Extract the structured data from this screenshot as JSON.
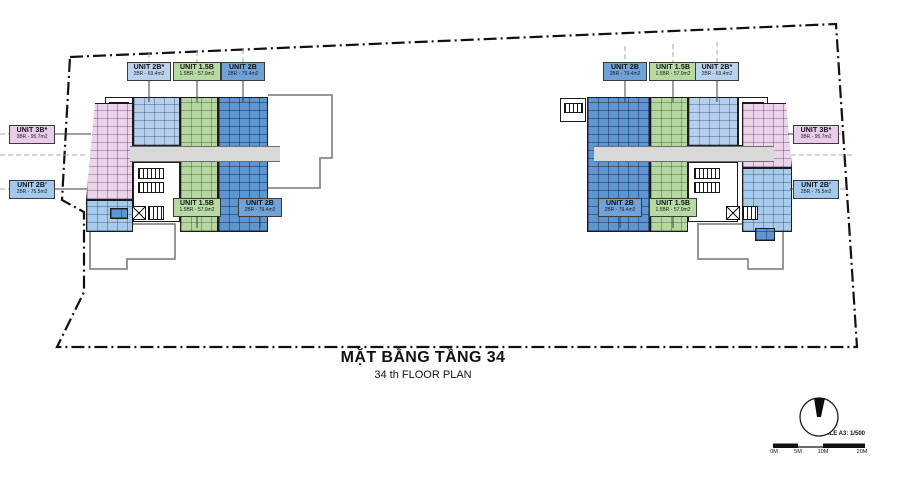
{
  "title": {
    "main": "MẶT BẰNG TẦNG 34",
    "sub": "34 th FLOOR PLAN"
  },
  "labels": [
    {
      "name": "UNIT 2B*",
      "area": "2BR - 69.4m2",
      "type": "2b_star"
    },
    {
      "name": "UNIT 1.5B",
      "area": "1.5BR - 57.0m2",
      "type": "1_5b"
    },
    {
      "name": "UNIT 2B",
      "area": "2BR - 79.4m2",
      "type": "2b"
    },
    {
      "name": "UNIT 1.5B",
      "area": "1.5BR - 57.0m2",
      "type": "1_5b"
    },
    {
      "name": "UNIT 2B",
      "area": "2BR - 79.4m2",
      "type": "2b"
    },
    {
      "name": "UNIT 3B*",
      "area": "3BR - 95.7m2",
      "type": "3b_star"
    },
    {
      "name": "UNIT 2B'",
      "area": "2BR - 75.5m2",
      "type": "2b_prime"
    },
    {
      "name": "UNIT 2B",
      "area": "2BR - 79.4m2",
      "type": "2b"
    },
    {
      "name": "UNIT 1.5B",
      "area": "1.5BR - 57.0m2",
      "type": "1_5b"
    },
    {
      "name": "UNIT 2B*",
      "area": "2BR - 69.4m2",
      "type": "2b_star"
    },
    {
      "name": "UNIT 2B",
      "area": "2BR - 79.4m2",
      "type": "2b"
    },
    {
      "name": "UNIT 1.5B",
      "area": "1.5BR - 57.0m2",
      "type": "1_5b"
    },
    {
      "name": "UNIT 3B*",
      "area": "3BR - 95.7m2",
      "type": "3b_star"
    },
    {
      "name": "UNIT 2B'",
      "area": "2BR - 75.5m2",
      "type": "2b_prime"
    }
  ],
  "scale_bar": {
    "label": "SCALE A3: 1/500",
    "marks": [
      "0M",
      "5M",
      "10M",
      "20M"
    ]
  },
  "icons": {
    "north": "north-arrow"
  },
  "palette": {
    "unit_2b": "#5e96d0",
    "unit_2b_star": "#b4d0ec",
    "unit_1_5b": "#b6d8a0",
    "unit_3b_star": "#ecd4ea",
    "unit_2b_prime": "#a6cbec",
    "corridor": "#d9d9d9",
    "boundary": "#111111"
  }
}
